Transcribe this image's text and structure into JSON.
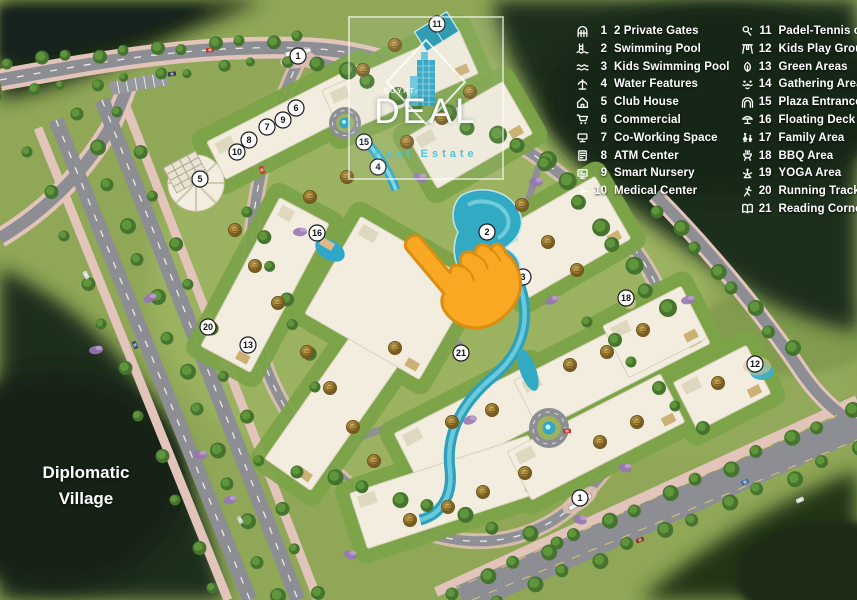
{
  "legend": {
    "items": [
      {
        "num": "1",
        "label": "2 Private Gates",
        "icon": "gate-icon"
      },
      {
        "num": "2",
        "label": "Swimming Pool",
        "icon": "swimming-pool-icon"
      },
      {
        "num": "3",
        "label": "Kids Swimming Pool",
        "icon": "kids-swimming-pool-icon"
      },
      {
        "num": "4",
        "label": "Water Features",
        "icon": "water-features-icon"
      },
      {
        "num": "5",
        "label": "Club House",
        "icon": "club-house-icon"
      },
      {
        "num": "6",
        "label": "Commercial",
        "icon": "commercial-icon"
      },
      {
        "num": "7",
        "label": "Co-Working Space",
        "icon": "co-working-space-icon"
      },
      {
        "num": "8",
        "label": "ATM Center",
        "icon": "atm-icon"
      },
      {
        "num": "9",
        "label": "Smart Nursery",
        "icon": "smart-nursery-icon"
      },
      {
        "num": "10",
        "label": "Medical Center",
        "icon": "medical-center-icon"
      },
      {
        "num": "11",
        "label": "Padel-Tennis court",
        "icon": "padel-tennis-icon"
      },
      {
        "num": "12",
        "label": "Kids Play Ground",
        "icon": "kids-playground-icon"
      },
      {
        "num": "13",
        "label": "Green Areas",
        "icon": "green-areas-icon"
      },
      {
        "num": "14",
        "label": "Gathering Area",
        "icon": "gathering-area-icon"
      },
      {
        "num": "15",
        "label": "Plaza Entrance",
        "icon": "plaza-entrance-icon"
      },
      {
        "num": "16",
        "label": "Floating Deck",
        "icon": "floating-deck-icon"
      },
      {
        "num": "17",
        "label": "Family Area",
        "icon": "family-area-icon"
      },
      {
        "num": "18",
        "label": "BBQ Area",
        "icon": "bbq-area-icon"
      },
      {
        "num": "19",
        "label": "YOGA Area",
        "icon": "yoga-area-icon"
      },
      {
        "num": "20",
        "label": "Running Track",
        "icon": "running-track-icon"
      },
      {
        "num": "21",
        "label": "Reading Corner",
        "icon": "reading-corner-icon"
      }
    ]
  },
  "logo": {
    "pre": "EGYPT-",
    "brand": "DEAL",
    "tagline": "Real Estate"
  },
  "map": {
    "area_label": "Diplomatic Village",
    "markers": [
      {
        "num": "1",
        "x": 298,
        "y": 56
      },
      {
        "num": "11",
        "x": 437,
        "y": 24
      },
      {
        "num": "6",
        "x": 296,
        "y": 108
      },
      {
        "num": "9",
        "x": 283,
        "y": 120
      },
      {
        "num": "7",
        "x": 267,
        "y": 127
      },
      {
        "num": "8",
        "x": 249,
        "y": 140
      },
      {
        "num": "10",
        "x": 237,
        "y": 152
      },
      {
        "num": "5",
        "x": 200,
        "y": 179
      },
      {
        "num": "15",
        "x": 364,
        "y": 142
      },
      {
        "num": "4",
        "x": 378,
        "y": 167
      },
      {
        "num": "2",
        "x": 487,
        "y": 232
      },
      {
        "num": "3",
        "x": 523,
        "y": 277
      },
      {
        "num": "16",
        "x": 317,
        "y": 233
      },
      {
        "num": "18",
        "x": 626,
        "y": 298
      },
      {
        "num": "12",
        "x": 755,
        "y": 364
      },
      {
        "num": "20",
        "x": 208,
        "y": 327
      },
      {
        "num": "13",
        "x": 248,
        "y": 345
      },
      {
        "num": "21",
        "x": 461,
        "y": 353
      },
      {
        "num": "1",
        "x": 580,
        "y": 498
      }
    ],
    "badges": [
      [
        363,
        70
      ],
      [
        395,
        45
      ],
      [
        407,
        142
      ],
      [
        442,
        118
      ],
      [
        470,
        92
      ],
      [
        310,
        197
      ],
      [
        347,
        177
      ],
      [
        235,
        230
      ],
      [
        255,
        266
      ],
      [
        278,
        303
      ],
      [
        307,
        352
      ],
      [
        330,
        388
      ],
      [
        353,
        427
      ],
      [
        374,
        461
      ],
      [
        395,
        348
      ],
      [
        452,
        422
      ],
      [
        492,
        410
      ],
      [
        522,
        205
      ],
      [
        548,
        242
      ],
      [
        577,
        270
      ],
      [
        570,
        365
      ],
      [
        607,
        352
      ],
      [
        643,
        330
      ],
      [
        637,
        422
      ],
      [
        600,
        442
      ],
      [
        718,
        383
      ],
      [
        525,
        473
      ],
      [
        483,
        492
      ],
      [
        448,
        507
      ],
      [
        410,
        520
      ]
    ],
    "colors": {
      "hand": "#F9A824",
      "water": "#33AAC4",
      "legend_text": "#FFFFFF",
      "badge_gold": "#A98937",
      "road": "#8C8E93",
      "sidewalk": "#E2C4BA",
      "accent_teal": "#4CC5DE"
    }
  }
}
